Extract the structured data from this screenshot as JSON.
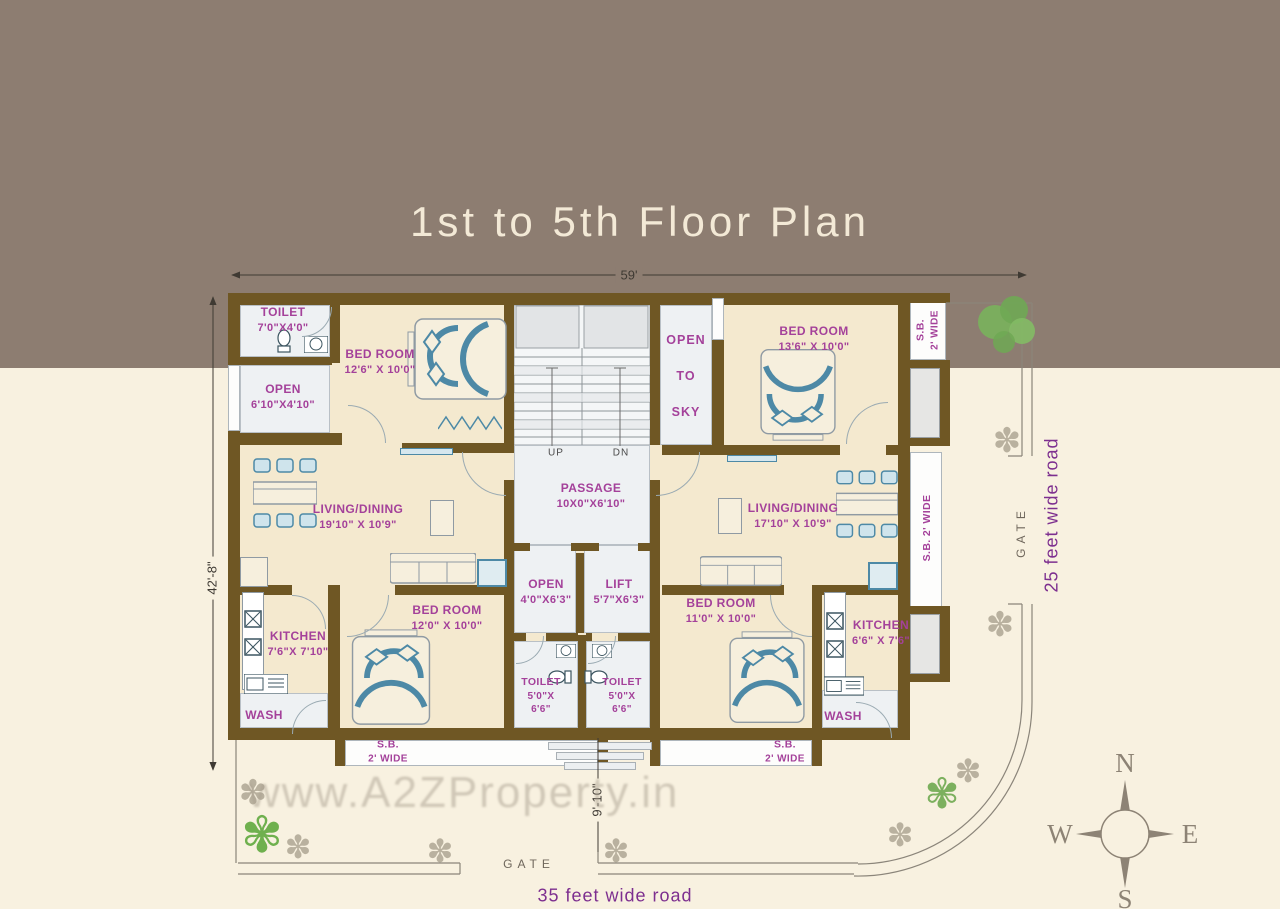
{
  "title": "1st to 5th Floor Plan",
  "watermark": "www.A2ZProperty.in",
  "dimensions": {
    "width_top": "59'",
    "height_left": "42'-8\"",
    "entry_offset": "9'-10\""
  },
  "roads": {
    "right": "25 feet wide road",
    "bottom": "35 feet wide road"
  },
  "gates": {
    "right": "GATE",
    "bottom": "GATE"
  },
  "compass": {
    "n": "N",
    "s": "S",
    "e": "E",
    "w": "W"
  },
  "stairs": {
    "up": "UP",
    "dn": "DN"
  },
  "rooms": {
    "toilet_top_left": {
      "name": "TOILET",
      "dim": "7'0\"X4'0\""
    },
    "open_top_left": {
      "name": "OPEN",
      "dim": "6'10\"X4'10\""
    },
    "bedroom_top_left": {
      "name": "BED ROOM",
      "dim": "12'6\" X 10'0\""
    },
    "open_to_sky": {
      "l1": "OPEN",
      "l2": "TO",
      "l3": "SKY"
    },
    "bedroom_top_right": {
      "name": "BED ROOM",
      "dim": "13'6\" X 10'0\""
    },
    "sb_top_right": {
      "name": "S.B.",
      "dim": "2' WIDE"
    },
    "living_left": {
      "name": "LIVING/DINING",
      "dim": "19'10\" X 10'9\""
    },
    "living_right": {
      "name": "LIVING/DINING",
      "dim": "17'10\" X 10'9\""
    },
    "sb_right": {
      "name": "S.B. 2' WIDE"
    },
    "passage": {
      "name": "PASSAGE",
      "dim": "10X0\"X6'10\""
    },
    "open_middle": {
      "name": "OPEN",
      "dim": "4'0\"X6'3\""
    },
    "lift": {
      "name": "LIFT",
      "dim": "5'7\"X6'3\""
    },
    "kitchen_left": {
      "name": "KITCHEN",
      "dim": "7'6\"X 7'10\""
    },
    "wash_left": {
      "name": "WASH"
    },
    "bedroom_bottom_left": {
      "name": "BED ROOM",
      "dim": "12'0\" X 10'0\""
    },
    "toilet_mid_left": {
      "name": "TOILET",
      "dim1": "5'0\"X",
      "dim2": "6'6\""
    },
    "toilet_mid_right": {
      "name": "TOILET",
      "dim1": "5'0\"X",
      "dim2": "6'6\""
    },
    "bedroom_bottom_right": {
      "name": "BED ROOM",
      "dim": "11'0\" X 10'0\""
    },
    "kitchen_right": {
      "name": "KITCHEN",
      "dim": "6'6\" X 7'6\""
    },
    "wash_right": {
      "name": "WASH"
    },
    "sb_bottom_left": {
      "name": "S.B.",
      "dim": "2' WIDE"
    },
    "sb_bottom_right": {
      "name": "S.B.",
      "dim": "2' WIDE"
    }
  },
  "colors": {
    "banner": "#8d7d71",
    "background": "#f8f1e0",
    "wall": "#6f5724",
    "room_fill": "#f4e9cf",
    "wet_room_fill": "#eef1f3",
    "room_label": "#a4419a",
    "road_label": "#7d2f8f",
    "furniture_accent": "#4d89a6",
    "dimension_text": "#3f3a33",
    "watermark": "#a89e8e",
    "compass": "#8d8375"
  }
}
